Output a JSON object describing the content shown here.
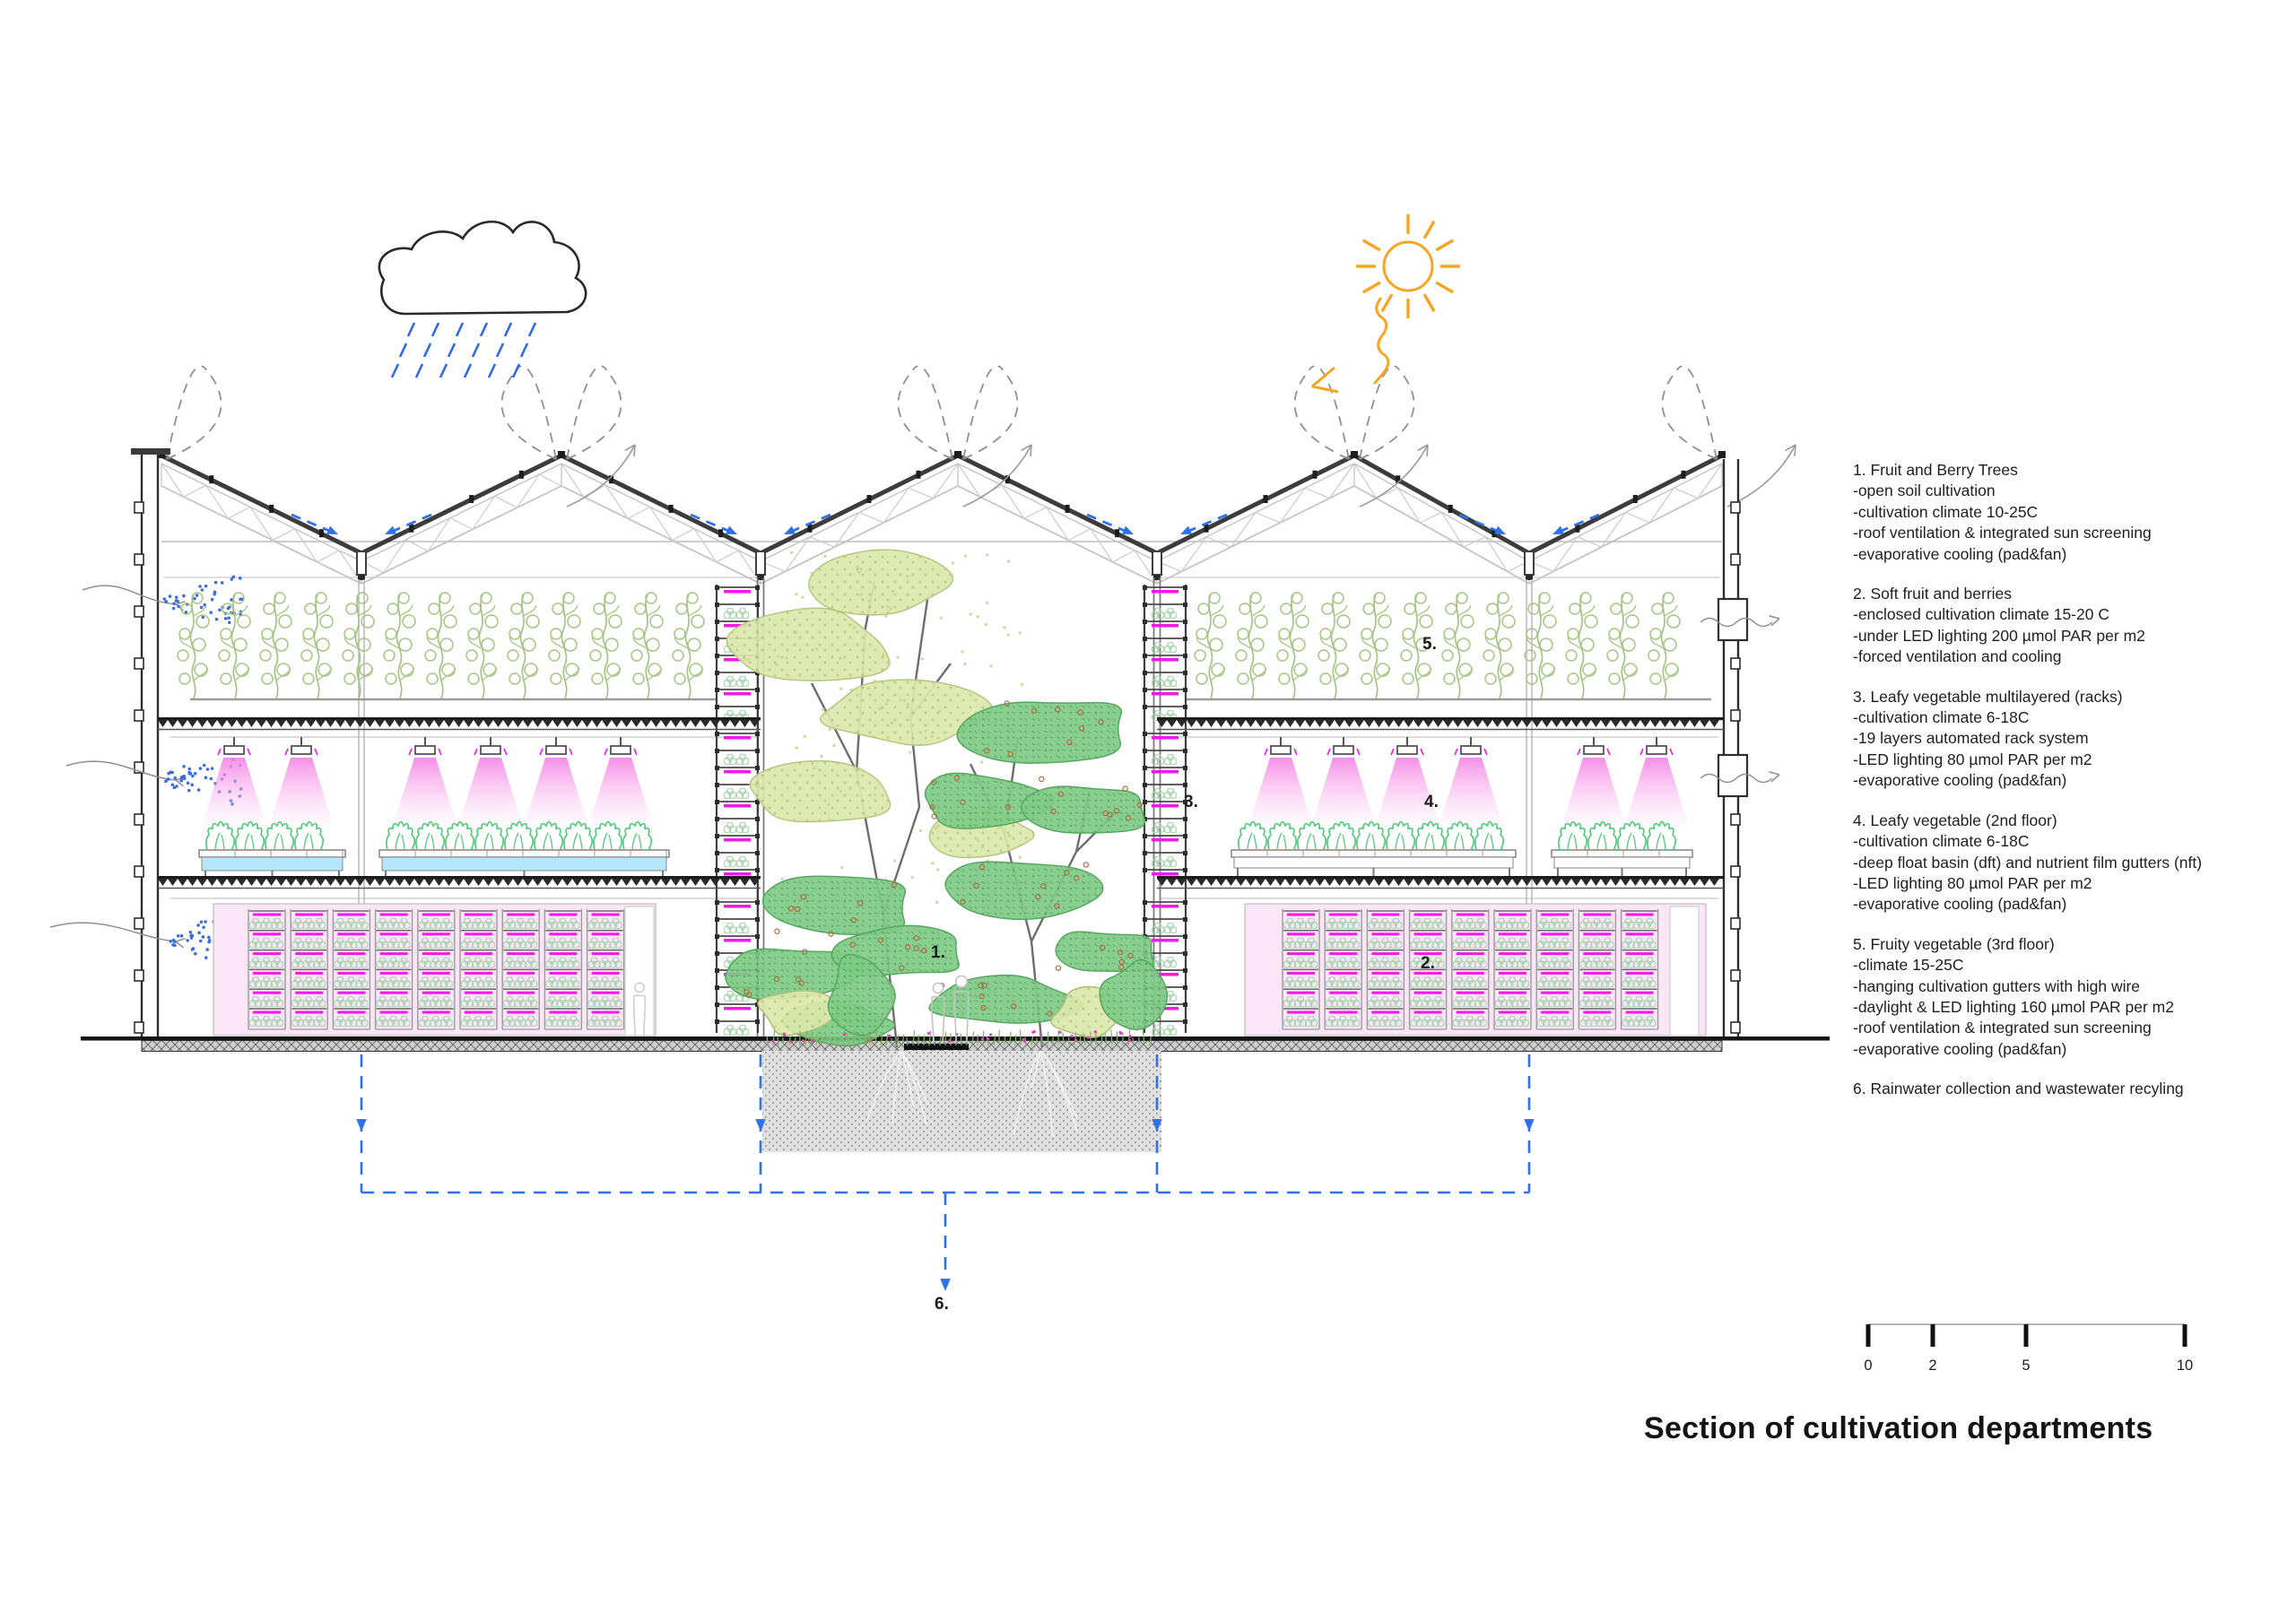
{
  "title": "Section of cultivation departments",
  "section_labels": {
    "l1": "1.",
    "l2": "2.",
    "l3": "3.",
    "l4": "4.",
    "l5": "5.",
    "l6": "6."
  },
  "legend": {
    "blocks": [
      {
        "lines": [
          "1. Fruit and Berry Trees",
          "-open soil cultivation",
          "-cultivation climate 10-25C",
          "-roof ventilation & integrated sun screening",
          "-evaporative cooling (pad&fan)"
        ]
      },
      {
        "lines": [
          "2. Soft fruit and berries",
          "-enclosed cultivation climate 15-20 C",
          "-under LED lighting 200 µmol PAR per m2",
          "-forced ventilation and cooling"
        ]
      },
      {
        "lines": [
          "3. Leafy vegetable multilayered (racks)",
          "-cultivation climate 6-18C",
          "-19 layers automated rack system",
          "-LED lighting 80 µmol PAR per m2",
          "-evaporative cooling (pad&fan)"
        ]
      },
      {
        "lines": [
          "4. Leafy vegetable (2nd floor)",
          "-cultivation climate 6-18C",
          "-deep float basin (dft) and nutrient film gutters (nft)",
          "-LED lighting 80 µmol PAR per m2",
          "-evaporative cooling (pad&fan)"
        ]
      },
      {
        "lines": [
          "5. Fruity vegetable (3rd floor)",
          "-climate 15-25C",
          "-hanging cultivation gutters with high wire",
          "-daylight & LED lighting 160 µmol PAR per m2",
          "-roof ventilation & integrated sun screening",
          "-evaporative cooling (pad&fan)"
        ]
      },
      {
        "lines": [
          "6. Rainwater collection and wastewater recyling"
        ]
      }
    ]
  },
  "scale_bar": {
    "ticks": [
      "0",
      "2",
      "5",
      "10"
    ]
  },
  "icons": {
    "sun": "sun-icon",
    "rain_cloud": "rain-cloud-icon",
    "air_intake": "air-intake-arrow-icon",
    "air_exhaust": "air-exhaust-arrow-icon",
    "evaporative_spray": "evaporative-cooling-spray-icon",
    "water_collection": "water-collection-arrow-icon"
  },
  "colors": {
    "accent_magenta": "#F318EC",
    "pink_room_fill": "#FBE6F7",
    "accent_blue": "#2D72E8",
    "accent_orange": "#F5A623",
    "vine_green": "#A6C584",
    "lettuce_green": "#57C97E",
    "basin_cyan": "#B5E6F9"
  }
}
